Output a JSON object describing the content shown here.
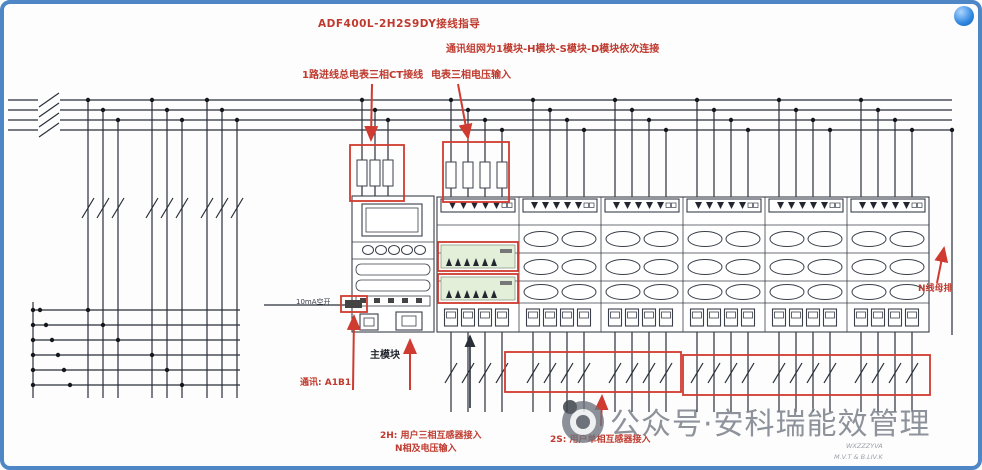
{
  "annotations": {
    "title": "ADF400L-2H2S9DY接线指导",
    "daisy_chain": "通讯组网为1模块-H模块-S模块-D模块依次连接",
    "ct_note": "1路进线总电表三相CT接线",
    "voltage_note": "电表三相电压输入",
    "main_module_label": "主模块",
    "breaker_label": "10mA空开",
    "comm_label": "通讯: A1B1",
    "right_label": "N线母排",
    "note_2h_line1": "2H: 用户三相互感器接入",
    "note_2h_line2": "N相及电压输入",
    "note_2s": "2S: 用户单相互感器接入"
  },
  "watermark": {
    "text": "公众号·安科瑞能效管理",
    "logo_icon": "camera-aperture-logo",
    "signature_lines": [
      "WXZZZYVA",
      "M.V.T & B.LIV.K"
    ]
  },
  "icons": {
    "corner": "blue-sphere-icon"
  },
  "colors": {
    "frame_blue": "#4e86c6",
    "annotation_red": "#bf3a2e",
    "highlight_red": "#cf3b30",
    "wire": "#2a2f3a",
    "watermark_gray": "#7b818b",
    "terminal_strip_green": "#e4efda"
  }
}
